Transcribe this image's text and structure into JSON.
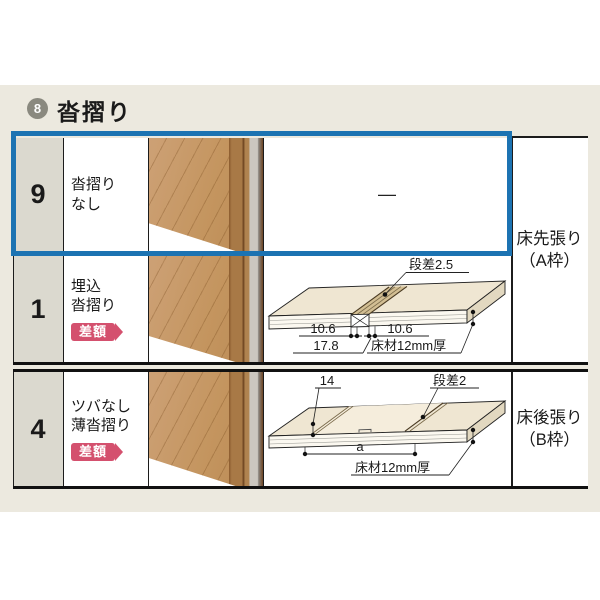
{
  "page": {
    "section_number": "8",
    "title": "沓摺り"
  },
  "table": {
    "rows": [
      {
        "num": "9",
        "name_line1": "沓摺り",
        "name_line2": "なし",
        "diagram_placeholder": "—"
      },
      {
        "num": "1",
        "name_line1": "埋込",
        "name_line2": "沓摺り",
        "badge": "差額"
      },
      {
        "num": "4",
        "name_line1": "ツバなし",
        "name_line2": "薄沓摺り",
        "badge": "差額"
      }
    ],
    "group_labels": [
      {
        "line1": "床先張り",
        "line2": "（A枠）"
      },
      {
        "line1": "床後張り",
        "line2": "（B枠）"
      }
    ]
  },
  "diagrams": {
    "embedded": {
      "step": "段差2.5",
      "dim_left": "10.6",
      "dim_right": "10.6",
      "dim_total": "17.8",
      "floor": "床材12mm厚"
    },
    "thin": {
      "width": "14",
      "step": "段差2",
      "span": "a",
      "floor": "床材12mm厚"
    }
  },
  "colors": {
    "highlight_blue": "#1C73B2",
    "badge_pink": "#D4506E",
    "page_band": "#ECE9DF"
  }
}
